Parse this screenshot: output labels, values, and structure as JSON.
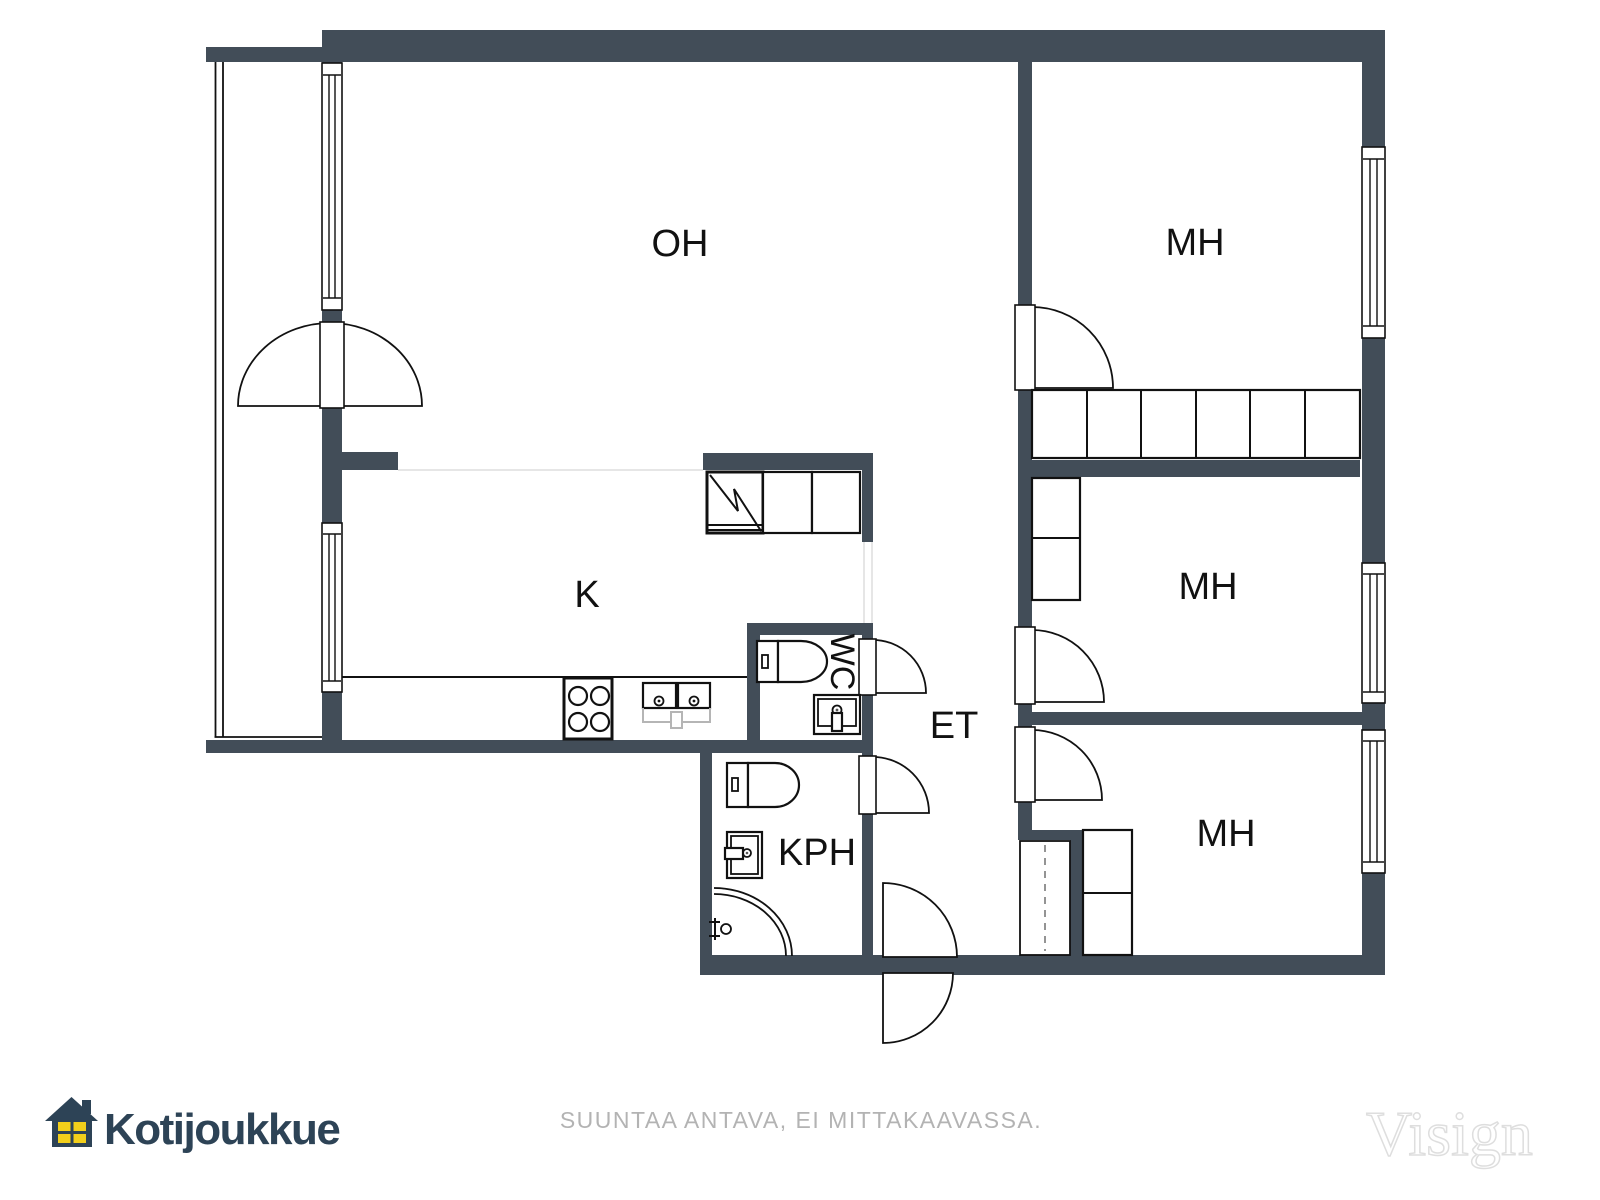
{
  "brand": {
    "name": "Kotijoukkue",
    "watermark": "Visign"
  },
  "footer": {
    "disclaimer": "SUUNTAA ANTAVA, EI MITTAKAAVASSA."
  },
  "colors": {
    "wall": "#424d58",
    "line": "#111111",
    "faint_line": "#e6e6e6",
    "brand_navy": "#2d4356",
    "brand_yellow": "#f2cf1b",
    "disclaimer_gray": "#b3b3b3",
    "watermark_outline": "#dedede"
  },
  "rooms": {
    "oh": {
      "label": "OH"
    },
    "k": {
      "label": "K"
    },
    "mh_top": {
      "label": "MH"
    },
    "mh_mid": {
      "label": "MH"
    },
    "mh_bottom": {
      "label": "MH"
    },
    "wc": {
      "label": "WC"
    },
    "et": {
      "label": "ET"
    },
    "kph": {
      "label": "KPH"
    }
  },
  "icons": {
    "logo": "house-icon",
    "fixtures": [
      "stove-icon",
      "kitchen-sink-icon",
      "fridge-icon",
      "toilet-icon",
      "washbasin-icon",
      "shower-icon",
      "wardrobe",
      "window",
      "door-swing",
      "entry-door-swing"
    ]
  }
}
